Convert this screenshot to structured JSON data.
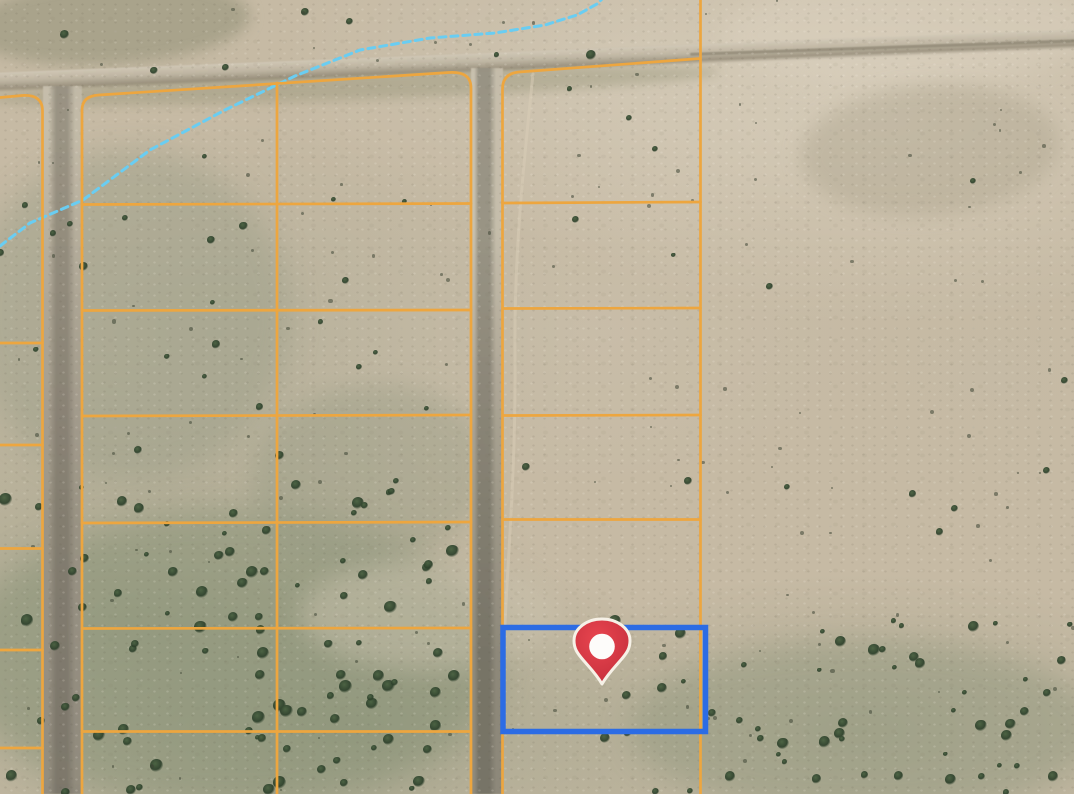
{
  "map": {
    "view": {
      "width": 1074,
      "height": 794,
      "imagery": "satellite-desert-parcels"
    },
    "colors": {
      "parcel_line": "#eda63f",
      "selection_blue": "#2c6ce4",
      "stream_blue": "#69cdf2",
      "trail": "#d9ceb7",
      "pin_fill_light": "#e8454f",
      "pin_fill_dark": "#c52f3c",
      "pin_ring": "#f6f1e7",
      "pin_dot": "#fdfcfa"
    },
    "parcel_lines": {
      "stroke_width": 2.7,
      "paths": [
        "M 0 97.5 L 22 95.5 Q 42.5 94 42.5 111 L 42.5 794",
        "M 0 343 L 42.5 343",
        "M 0 445 L 42.5 445",
        "M 0 548.5 L 42.5 548.5",
        "M 0 650 L 42.5 650",
        "M 0 748 L 42.5 748",
        "M 82 794 L 82 110 Q 82 96 99 95 L 449 72.5 Q 471 71 471 88 L 471 794",
        "M 277 83 L 277 794",
        "M 82 204.5 L 471 203.5",
        "M 82 310.5 L 471 310",
        "M 82 416 L 471 415",
        "M 82 523 L 471 522",
        "M 82 628.5 L 471 628",
        "M 82 731.5 L 471 731.5",
        "M 502.5 794 L 502.5 89 Q 502.5 73.5 519 72 L 700.5 58.5",
        "M 700.5 0 L 700.5 794",
        "M 502.5 203 L 700.5 202",
        "M 502.5 308.5 L 700.5 308",
        "M 502.5 415.5 L 700.5 415",
        "M 502.5 519.5 L 700.5 519.5",
        "M 502.5 627.5 L 700.5 627.5",
        "M 502.5 731.5 L 700.5 731.5"
      ]
    },
    "stream": {
      "dash": "7 5",
      "stroke_width": 3,
      "points": [
        [
          0,
          246
        ],
        [
          30,
          223
        ],
        [
          83,
          200
        ],
        [
          150,
          150
        ],
        [
          225,
          110
        ],
        [
          295,
          76
        ],
        [
          360,
          50
        ],
        [
          430,
          38
        ],
        [
          495,
          33
        ],
        [
          545,
          25
        ],
        [
          577,
          15
        ],
        [
          597,
          4
        ],
        [
          603,
          -2
        ]
      ]
    },
    "trail": {
      "path": "M 533 74 C 523 170 514 255 515 355 C 516 465 508 555 505 624",
      "stroke_width": 3,
      "opacity": 0.5
    },
    "selected_parcel": {
      "x": 503,
      "y": 627.5,
      "width": 202.5,
      "height": 104,
      "stroke_width": 5.5
    },
    "pin": {
      "cx": 602,
      "cy": 646.5,
      "dot_radius": 12.8,
      "ring_width": 3
    },
    "roads": [
      {
        "name": "dirt-road-top",
        "cls": "road-h",
        "x": -12,
        "y": 51,
        "w": 1100,
        "h": 16,
        "rot": -2.3
      },
      {
        "name": "dirt-road-top-track",
        "cls": "road-track",
        "x": 690,
        "y": 46,
        "w": 390,
        "h": 3,
        "rot": -2.0
      },
      {
        "name": "dirt-road-left",
        "cls": "road-v-left",
        "x": 43,
        "y": 86,
        "w": 39,
        "h": 708,
        "rot": 0
      },
      {
        "name": "dirt-road-right",
        "cls": "road-v-right",
        "x": 471,
        "y": 68,
        "w": 32,
        "h": 726,
        "rot": 0
      }
    ],
    "terrain_patches": [
      {
        "x": -30,
        "y": -20,
        "w": 280,
        "h": 85,
        "rot": -3,
        "color": "rgba(139,140,113,0.5)",
        "blur": 7
      },
      {
        "x": 720,
        "y": -25,
        "w": 380,
        "h": 110,
        "rot": -2,
        "color": "rgba(219,210,191,0.5)",
        "blur": 12
      },
      {
        "x": -10,
        "y": 71,
        "w": 730,
        "h": 29,
        "rot": -2.1,
        "color": "rgba(141,141,112,0.38)",
        "blur": 5
      },
      {
        "x": -30,
        "y": 150,
        "w": 320,
        "h": 330,
        "rot": 0,
        "color": "rgba(151,155,133,0.4)",
        "blur": 14
      },
      {
        "x": -40,
        "y": 510,
        "w": 540,
        "h": 300,
        "rot": 0,
        "color": "rgba(125,138,110,0.42)",
        "blur": 16
      },
      {
        "x": 250,
        "y": 385,
        "w": 240,
        "h": 180,
        "rot": -8,
        "color": "rgba(146,153,128,0.38)",
        "blur": 12
      },
      {
        "x": 300,
        "y": 560,
        "w": 260,
        "h": 110,
        "rot": 0,
        "color": "rgba(206,197,177,0.45)",
        "blur": 12
      },
      {
        "x": 630,
        "y": 640,
        "w": 470,
        "h": 175,
        "rot": 0,
        "color": "rgba(135,144,118,0.38)",
        "blur": 14
      },
      {
        "x": 800,
        "y": 85,
        "w": 260,
        "h": 130,
        "rot": -4,
        "color": "rgba(173,164,141,0.45)",
        "blur": 9
      }
    ],
    "tree_clusters": [
      {
        "x": 0,
        "y": 480,
        "w": 470,
        "h": 314,
        "count": 95,
        "min": 5,
        "max": 13
      },
      {
        "x": 0,
        "y": 140,
        "w": 300,
        "h": 340,
        "count": 20,
        "min": 4,
        "max": 9
      },
      {
        "x": 300,
        "y": 180,
        "w": 170,
        "h": 290,
        "count": 9,
        "min": 4,
        "max": 8
      },
      {
        "x": 505,
        "y": 80,
        "w": 190,
        "h": 540,
        "count": 9,
        "min": 4,
        "max": 8
      },
      {
        "x": 705,
        "y": 70,
        "w": 360,
        "h": 550,
        "count": 13,
        "min": 3,
        "max": 8
      },
      {
        "x": 600,
        "y": 615,
        "w": 474,
        "h": 179,
        "count": 60,
        "min": 4,
        "max": 12
      },
      {
        "x": 0,
        "y": 5,
        "w": 690,
        "h": 75,
        "count": 7,
        "min": 5,
        "max": 10
      },
      {
        "x": 0,
        "y": 0,
        "w": 1074,
        "h": 794,
        "count": 120,
        "min": 2,
        "max": 4
      }
    ]
  }
}
